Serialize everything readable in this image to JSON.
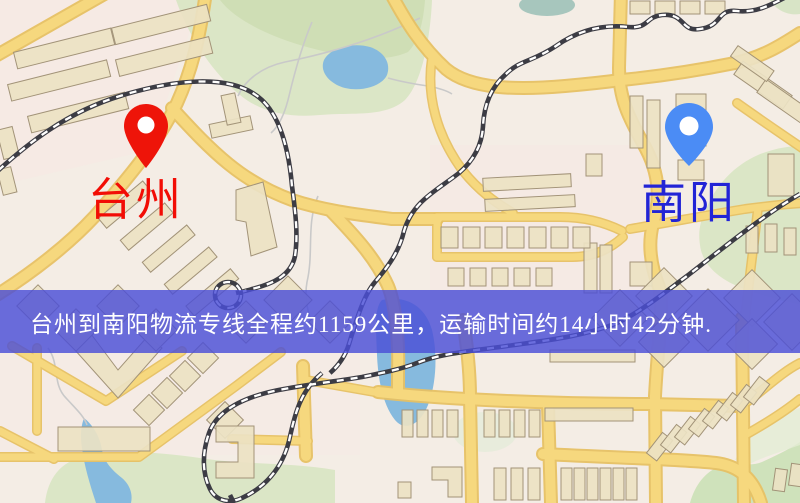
{
  "banner": {
    "text": "台州到南阳物流专线全程约1159公里，运输时间约14小时42分钟."
  },
  "markers": {
    "origin": {
      "label": "台州",
      "pin_color": "#ee1409",
      "label_color": "#f20d05"
    },
    "destination": {
      "label": "南阳",
      "pin_color": "#4b8cf5",
      "label_color": "#2224d6"
    }
  },
  "colors": {
    "banner_bg_rgba": "rgba(74,78,215,0.82)",
    "banner_text": "#ffffff",
    "origin_pin": "#ee1409",
    "origin_label": "#f20d05",
    "dest_pin": "#4b8cf5",
    "dest_label": "#2224d6",
    "road_fill": "#f6d87e",
    "road_casing": "#e7c164",
    "park": "#dbe6c6",
    "water": "#86bade",
    "building": "#ece2c3",
    "railway": "#3c3c44",
    "ground": "#f4ede5"
  }
}
